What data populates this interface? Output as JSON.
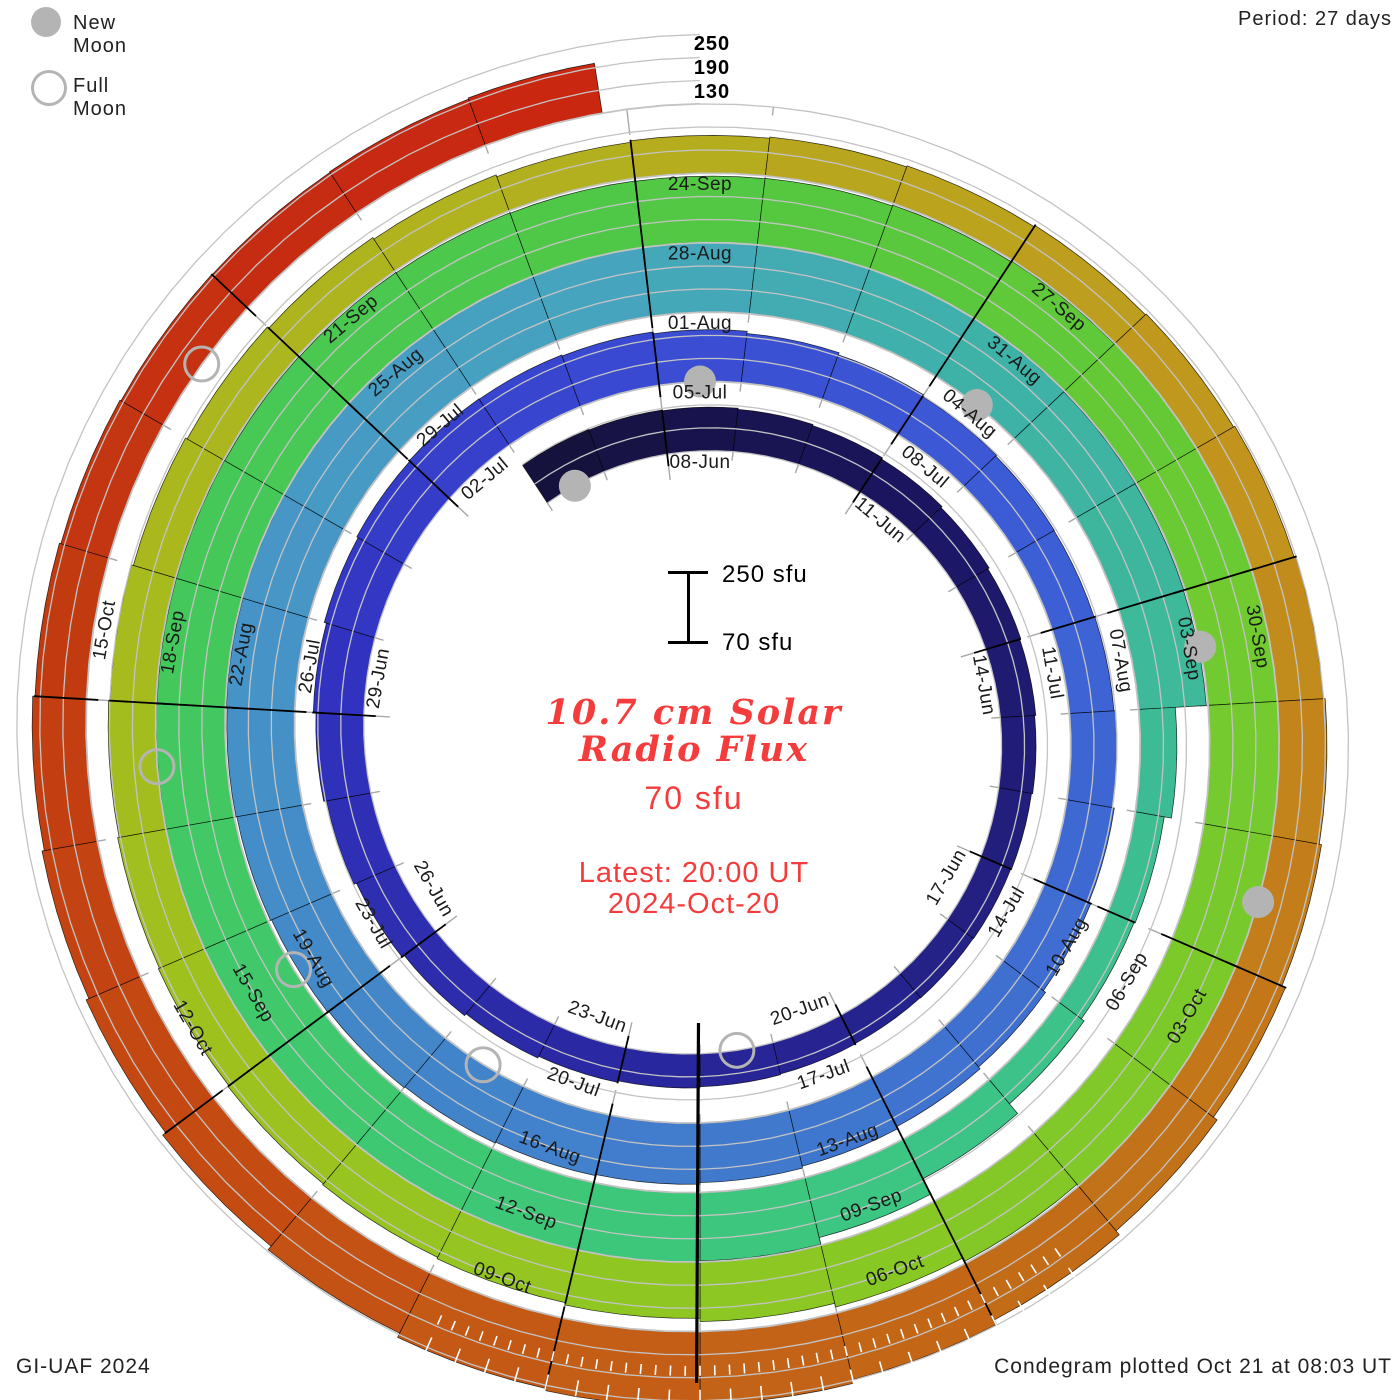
{
  "legend": {
    "new_moon": "New Moon",
    "full_moon": "Full Moon"
  },
  "header": {
    "period": "Period: 27 days"
  },
  "footer": {
    "credit": "GI-UAF 2024",
    "plotted": "Condegram plotted Oct 21 at 08:03 UT"
  },
  "center": {
    "title_line1": "10.7 cm Solar",
    "title_line2": "Radio Flux",
    "baseline_value": "70 sfu",
    "latest_line1": "Latest: 20:00 UT",
    "latest_line2": "2024-Oct-20"
  },
  "radial_scale": {
    "labels": [
      "250",
      "190",
      "130"
    ],
    "bar_top": "250 sfu",
    "bar_bottom": "70 sfu"
  },
  "colors": {
    "moon_gray": "#b4b4b4",
    "grid_gray": "#c3c3c3",
    "tick_gray": "#a8a8a8",
    "title_red": "#f43c3c",
    "outline_black": "#000000",
    "label_black": "#1a1a1a"
  },
  "chart_data": {
    "type": "condegram_spiral",
    "title": "10.7 cm Solar Radio Flux",
    "period_days": 27,
    "baseline_sfu": 70,
    "flux_gridlines_sfu": [
      130,
      190,
      250
    ],
    "start_date": "2024-06-06",
    "end_date": "2024-10-20",
    "latest": "2024-Oct-20 20:00 UT",
    "label_step_days": 3,
    "date_labels": [
      "08-Jun",
      "11-Jun",
      "14-Jun",
      "17-Jun",
      "20-Jun",
      "23-Jun",
      "26-Jun",
      "29-Jun",
      "02-Jul",
      "05-Jul",
      "08-Jul",
      "11-Jul",
      "14-Jul",
      "17-Jul",
      "20-Jul",
      "23-Jul",
      "26-Jul",
      "29-Jul",
      "01-Aug",
      "04-Aug",
      "07-Aug",
      "10-Aug",
      "13-Aug",
      "16-Aug",
      "19-Aug",
      "22-Aug",
      "25-Aug",
      "28-Aug",
      "31-Aug",
      "03-Sep",
      "06-Sep",
      "09-Sep",
      "12-Sep",
      "15-Sep",
      "18-Sep",
      "21-Sep",
      "24-Sep",
      "27-Sep",
      "30-Sep",
      "03-Oct",
      "06-Oct",
      "09-Oct",
      "12-Oct",
      "15-Oct"
    ],
    "daily_flux_sfu": [
      188,
      186,
      184,
      181,
      178,
      174,
      170,
      166,
      163,
      160,
      157,
      155,
      154,
      153,
      154,
      156,
      159,
      163,
      168,
      174,
      181,
      188,
      195,
      202,
      208,
      212,
      214,
      213,
      210,
      205,
      199,
      193,
      188,
      185,
      184,
      186,
      190,
      195,
      201,
      208,
      214,
      220,
      225,
      229,
      232,
      235,
      238,
      241,
      244,
      246,
      248,
      249,
      250,
      251,
      251,
      252,
      252,
      251,
      250,
      249,
      248,
      247,
      246,
      165,
      146,
      143,
      152,
      185,
      230,
      248,
      250,
      251,
      252,
      252,
      251,
      250,
      249,
      248,
      248,
      247,
      246,
      245,
      244,
      243,
      244,
      246,
      248,
      251,
      255,
      260,
      263,
      262,
      258,
      252,
      245,
      235,
      225,
      216,
      210,
      206,
      203,
      200,
      197,
      193,
      189,
      184,
      179,
      174,
      169,
      164,
      168,
      171,
      174,
      178,
      181,
      185,
      189,
      194,
      200,
      210,
      222,
      235,
      248,
      258,
      264,
      258,
      246,
      234,
      224,
      216,
      210,
      204,
      200,
      197,
      196,
      198,
      201
    ],
    "color_stops_by_day": [
      [
        0,
        "#16123e"
      ],
      [
        5,
        "#1b1560"
      ],
      [
        11,
        "#232082"
      ],
      [
        17,
        "#2a28a2"
      ],
      [
        23,
        "#3133c0"
      ],
      [
        28,
        "#3a49d2"
      ],
      [
        33,
        "#3c5cd6"
      ],
      [
        39,
        "#3f70d0"
      ],
      [
        45,
        "#4284ca"
      ],
      [
        51,
        "#4796c6"
      ],
      [
        55,
        "#46a4be"
      ],
      [
        58,
        "#40b0ac"
      ],
      [
        61,
        "#3eb69e"
      ],
      [
        64,
        "#3dbe90"
      ],
      [
        68,
        "#3cc682"
      ],
      [
        73,
        "#3fc86e"
      ],
      [
        77,
        "#44c85c"
      ],
      [
        81,
        "#4cc84c"
      ],
      [
        85,
        "#59c83c"
      ],
      [
        89,
        "#70ca30"
      ],
      [
        93,
        "#80c928"
      ],
      [
        97,
        "#90c622"
      ],
      [
        101,
        "#9ec11e"
      ],
      [
        105,
        "#aab81e"
      ],
      [
        109,
        "#b2b01e"
      ],
      [
        112,
        "#bba31e"
      ],
      [
        115,
        "#c2931d"
      ],
      [
        118,
        "#c37d1a"
      ],
      [
        121,
        "#c26c18"
      ],
      [
        124,
        "#c45e16"
      ],
      [
        127,
        "#c44c13"
      ],
      [
        131,
        "#c23b10"
      ],
      [
        134,
        "#c62c12"
      ],
      [
        137,
        "#cc2411"
      ]
    ],
    "new_moon_days": [
      0,
      29,
      59,
      89,
      118
    ],
    "full_moon_days": [
      15,
      45,
      74,
      103,
      133
    ]
  }
}
